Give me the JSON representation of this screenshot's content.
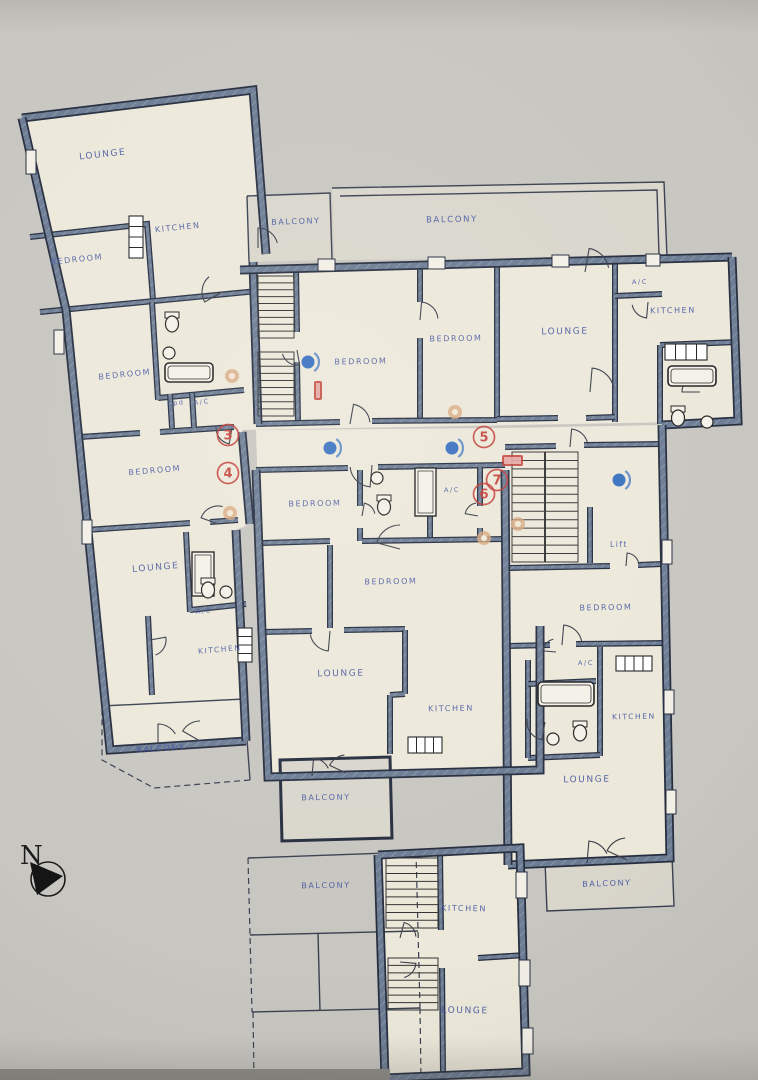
{
  "title": "Apartment building floor plan",
  "colors": {
    "paper": "#c8c6c0",
    "floor": "#ece8da",
    "balcony_floor": "#d9d6cc",
    "wall_fill": "#6c7c93",
    "wall_hatch": "#8694a8",
    "wall_dark": "#252d3f",
    "thin_line": "#3a4050",
    "label_blue": "#3f51a0",
    "marker_red": "#c23b33",
    "marker_blue": "#3a72c0",
    "marker_orange": "#d9a97f"
  },
  "rooms": [
    {
      "label": "LOUNGE",
      "x": 103,
      "y": 157,
      "r": -6,
      "s": 9
    },
    {
      "label": "KITCHEN",
      "x": 178,
      "y": 230,
      "r": -6,
      "s": 8
    },
    {
      "label": "BEDROOM",
      "x": 77,
      "y": 262,
      "r": -6,
      "s": 8
    },
    {
      "label": "BALCONY",
      "x": 296,
      "y": 224,
      "r": -2,
      "s": 8
    },
    {
      "label": "BALCONY",
      "x": 452,
      "y": 222,
      "r": -1,
      "s": 8.5
    },
    {
      "label": "BEDROOM",
      "x": 125,
      "y": 377,
      "r": -6,
      "s": 8
    },
    {
      "label": "Cpd",
      "x": 176,
      "y": 405,
      "r": -6,
      "s": 6.5
    },
    {
      "label": "A/C",
      "x": 202,
      "y": 404,
      "r": -6,
      "s": 6.5
    },
    {
      "label": "BEDROOM",
      "x": 155,
      "y": 473,
      "r": -5,
      "s": 8
    },
    {
      "label": "LOUNGE",
      "x": 156,
      "y": 570,
      "r": -5,
      "s": 9
    },
    {
      "label": "A/C",
      "x": 204,
      "y": 613,
      "r": -5,
      "s": 6.5
    },
    {
      "label": "KITCHEN",
      "x": 220,
      "y": 652,
      "r": -5,
      "s": 7.5
    },
    {
      "label": "BALCONY",
      "x": 161,
      "y": 751,
      "r": -4,
      "s": 8
    },
    {
      "label": "BEDROOM",
      "x": 361,
      "y": 364,
      "r": -1,
      "s": 8
    },
    {
      "label": "BEDROOM",
      "x": 456,
      "y": 341,
      "r": -1,
      "s": 8
    },
    {
      "label": "LOUNGE",
      "x": 565,
      "y": 334,
      "r": -1,
      "s": 9
    },
    {
      "label": "A/C",
      "x": 640,
      "y": 284,
      "r": -1,
      "s": 6.5
    },
    {
      "label": "KITCHEN",
      "x": 673,
      "y": 313,
      "r": -1,
      "s": 8
    },
    {
      "label": "BEDROOM",
      "x": 315,
      "y": 506,
      "r": -1,
      "s": 8
    },
    {
      "label": "A/C",
      "x": 452,
      "y": 492,
      "r": -1,
      "s": 6.5
    },
    {
      "label": "BEDROOM",
      "x": 391,
      "y": 584,
      "r": -1,
      "s": 8
    },
    {
      "label": "Lift",
      "x": 619,
      "y": 547,
      "r": 0,
      "s": 7.5
    },
    {
      "label": "BEDROOM",
      "x": 606,
      "y": 610,
      "r": -1,
      "s": 8
    },
    {
      "label": "LOUNGE",
      "x": 341,
      "y": 676,
      "r": -1,
      "s": 9
    },
    {
      "label": "KITCHEN",
      "x": 451,
      "y": 711,
      "r": -1,
      "s": 8
    },
    {
      "label": "BALCONY",
      "x": 326,
      "y": 800,
      "r": -1,
      "s": 8
    },
    {
      "label": "A/C",
      "x": 586,
      "y": 665,
      "r": -1,
      "s": 6.5
    },
    {
      "label": "KITCHEN",
      "x": 634,
      "y": 719,
      "r": -1,
      "s": 7.5
    },
    {
      "label": "LOUNGE",
      "x": 587,
      "y": 782,
      "r": -1,
      "s": 9
    },
    {
      "label": "BALCONY",
      "x": 607,
      "y": 886,
      "r": -2,
      "s": 8
    },
    {
      "label": "BALCONY",
      "x": 326,
      "y": 888,
      "r": -1,
      "s": 8
    },
    {
      "label": "KITCHEN",
      "x": 464,
      "y": 911,
      "r": 1,
      "s": 8
    },
    {
      "label": "LOUNGE",
      "x": 465,
      "y": 1013,
      "r": 1,
      "s": 9
    }
  ],
  "markers": {
    "circled_numbers": [
      {
        "value": "3",
        "x": 228,
        "y": 435
      },
      {
        "value": "4",
        "x": 228,
        "y": 473
      },
      {
        "value": "5",
        "x": 484,
        "y": 437
      },
      {
        "value": "6",
        "x": 484,
        "y": 494
      },
      {
        "value": "7",
        "x": 497,
        "y": 480
      }
    ],
    "blue_dots": [
      {
        "x": 308,
        "y": 362
      },
      {
        "x": 330,
        "y": 448
      },
      {
        "x": 452,
        "y": 448
      },
      {
        "x": 619,
        "y": 480
      }
    ],
    "orange_dots": [
      {
        "x": 232,
        "y": 376
      },
      {
        "x": 230,
        "y": 513
      },
      {
        "x": 455,
        "y": 412
      },
      {
        "x": 484,
        "y": 538
      },
      {
        "x": 518,
        "y": 524
      }
    ],
    "red_rects": [
      {
        "x": 314,
        "y": 381,
        "w": 8,
        "h": 19
      },
      {
        "x": 502,
        "y": 455,
        "w": 21,
        "h": 11
      }
    ]
  },
  "compass": {
    "letter": "N"
  }
}
